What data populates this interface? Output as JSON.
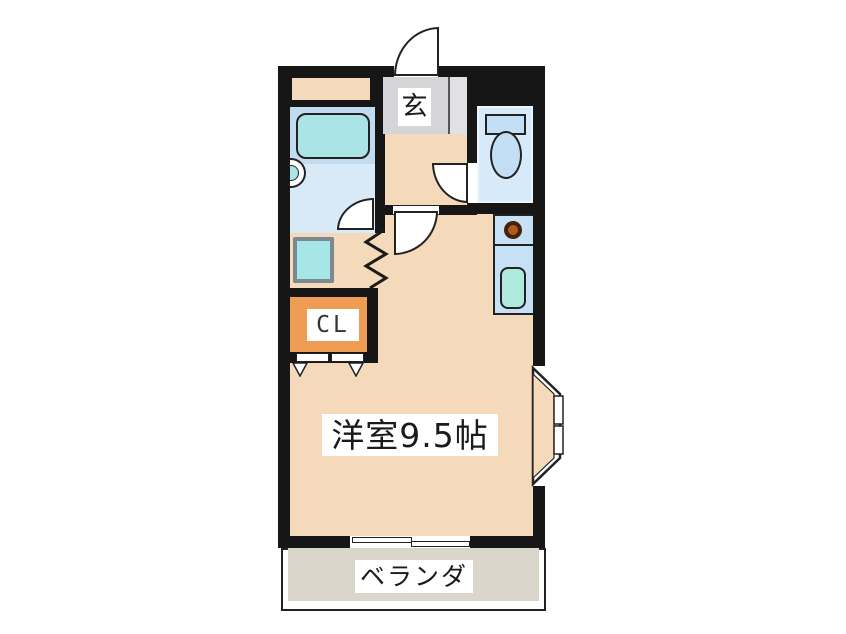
{
  "floorplan": {
    "labels": {
      "entrance": "玄",
      "closet": "CL",
      "main_room": "洋室9.5帖",
      "balcony": "ベランダ"
    },
    "colors": {
      "wall": "#161616",
      "floor": "#F4DABB",
      "entrance_floor": "#D5D5D7",
      "entrance_step": "#E1E1E3",
      "bathroom_floor": "#D8EAF8",
      "bathtub_deck": "#C2DBEE",
      "bathtub": "#ABE4E6",
      "washer_pan": "#A5E6E8",
      "washer_pan_frame": "#7E8890",
      "closet": "#EF9D55",
      "toilet_room": "#D6EAFA",
      "toilet_fixture": "#C3DFF5",
      "kitchen_counter": "#C6E0F6",
      "kitchen_sink": "#AFEADF",
      "burner": "#B05A1E",
      "balcony_floor": "#DAD6CC"
    }
  }
}
